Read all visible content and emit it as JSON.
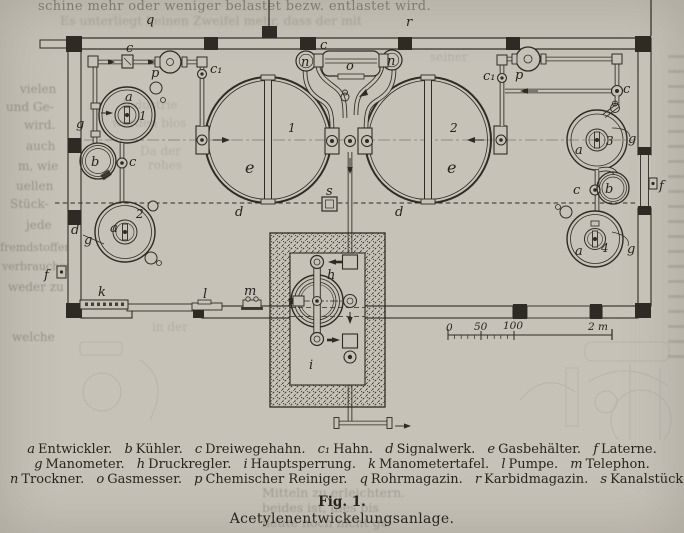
{
  "page": {
    "bg": "#c6c2b8",
    "ink": "#2e2b25"
  },
  "ghost": {
    "top_line1": "schine mehr oder weniger belastet bezw. entlastet wird.",
    "top_line2": "Es unterliegt keinen Zweifel mehr, dass der mit",
    "left": [
      "vielen",
      "und Ge-",
      "wird.",
      "auch",
      "m, wie",
      "uellen",
      "Stück-",
      "jede",
      "fremdstoffen",
      "verbrauchen",
      "weder zu",
      "welche"
    ],
    "inner": [
      "Industrie",
      "werden blos",
      "Da der",
      "rohes",
      "seiner",
      "in der"
    ],
    "caption_side": [
      "Mitteln zu erleichtern.",
      "beides ist, dies bis",
      "heute noch nicht ge-"
    ]
  },
  "diagram": {
    "glyphs": {
      "a": "a",
      "b": "b",
      "c": "c",
      "c1": "c₁",
      "d": "d",
      "e": "e",
      "f": "f",
      "g": "g",
      "h": "h",
      "i": "i",
      "k": "k",
      "l": "l",
      "m": "m",
      "n": "n",
      "o": "o",
      "p": "p",
      "q": "q",
      "r": "r",
      "s": "s",
      "n1": "1",
      "n2": "2",
      "n3": "3",
      "n4": "4"
    },
    "scale": {
      "zero": "0",
      "fifty": "50",
      "hundred": "100",
      "two_m": "2 m"
    }
  },
  "caption": {
    "items": [
      {
        "k": "a",
        "v": "Entwickler."
      },
      {
        "k": "b",
        "v": "Kühler."
      },
      {
        "k": "c",
        "v": "Dreiwegehahn."
      },
      {
        "k": "c₁",
        "v": "Hahn."
      },
      {
        "k": "d",
        "v": "Signalwerk."
      },
      {
        "k": "e",
        "v": "Gasbehälter."
      },
      {
        "k": "f",
        "v": "Laterne."
      },
      {
        "k": "g",
        "v": "Manometer."
      },
      {
        "k": "h",
        "v": "Druckregler."
      },
      {
        "k": "i",
        "v": "Hauptsperrung."
      },
      {
        "k": "k",
        "v": "Manometertafel."
      },
      {
        "k": "l",
        "v": "Pumpe."
      },
      {
        "k": "m",
        "v": "Telephon."
      },
      {
        "k": "n",
        "v": "Trockner."
      },
      {
        "k": "o",
        "v": "Gasmesser."
      },
      {
        "k": "p",
        "v": "Chemischer Reiniger."
      },
      {
        "k": "q",
        "v": "Rohrmagazin."
      },
      {
        "k": "r",
        "v": "Karbidmagazin."
      },
      {
        "k": "s",
        "v": "Kanalstück."
      }
    ]
  },
  "figure": {
    "fig_label": "Fig. 1.",
    "title": "Acetylenentwickelungsanlage."
  }
}
